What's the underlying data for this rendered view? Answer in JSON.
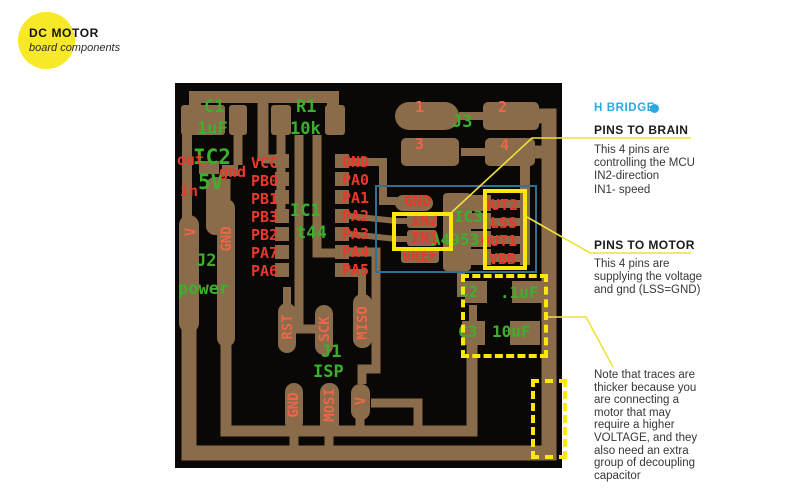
{
  "badge": {
    "title": "DC MOTOR",
    "subtitle": "board components"
  },
  "panel": {
    "h_bridge": "H BRIDGE",
    "brain_heading": "PINS TO BRAIN",
    "brain_lines": [
      "This 4 pins are",
      "controlling the MCU",
      "IN2-direction",
      "IN1- speed"
    ],
    "motor_heading": "PINS TO MOTOR",
    "motor_lines": [
      "This 4 pins are",
      "supplying the voltage",
      "and gnd (LSS=GND)"
    ],
    "note_lines": [
      "Note that traces are",
      "thicker because you",
      "are connecting a",
      "motor that may",
      "require a higher",
      "VOLTAGE, and they",
      "also need an extra",
      "group of decoupling",
      "capacitor"
    ]
  },
  "colors": {
    "badge_yellow": "#f7e928",
    "highlight_yellow": "#fde70a",
    "cyan": "#29abe2",
    "copper": "#8a6b4a",
    "board_black": "#0a0806",
    "silk_green": "#3cb02c",
    "silk_red": "#e8392b",
    "silk_orange": "#ee6648",
    "region_blue": "#2d7196"
  },
  "pcb": {
    "labels": [
      {
        "t": "C1",
        "c": "g",
        "x": 29,
        "y": 16,
        "s": 17
      },
      {
        "t": "1uF",
        "c": "g",
        "x": 22,
        "y": 38,
        "s": 17
      },
      {
        "t": "R1",
        "c": "g",
        "x": 121,
        "y": 16,
        "s": 17
      },
      {
        "t": "10k",
        "c": "g",
        "x": 115,
        "y": 38,
        "s": 17
      },
      {
        "t": "IC2",
        "c": "g",
        "x": 18,
        "y": 64,
        "s": 21
      },
      {
        "t": "5V",
        "c": "g",
        "x": 23,
        "y": 89,
        "s": 21
      },
      {
        "t": "out",
        "c": "r",
        "x": 2,
        "y": 70,
        "s": 15
      },
      {
        "t": "gnd",
        "c": "r",
        "x": 44,
        "y": 82,
        "s": 15
      },
      {
        "t": "in",
        "c": "r",
        "x": 5,
        "y": 101,
        "s": 15
      },
      {
        "t": "IC1",
        "c": "g",
        "x": 115,
        "y": 120,
        "s": 17
      },
      {
        "t": "t44",
        "c": "g",
        "x": 121,
        "y": 142,
        "s": 17
      },
      {
        "t": "J3",
        "c": "g",
        "x": 277,
        "y": 31,
        "s": 17
      },
      {
        "t": "J2",
        "c": "g",
        "x": 21,
        "y": 170,
        "s": 17
      },
      {
        "t": "power",
        "c": "g",
        "x": 3,
        "y": 198,
        "s": 17
      },
      {
        "t": "J1",
        "c": "g",
        "x": 146,
        "y": 261,
        "s": 17
      },
      {
        "t": "ISP",
        "c": "g",
        "x": 138,
        "y": 281,
        "s": 17
      },
      {
        "t": "IC3",
        "c": "g",
        "x": 279,
        "y": 126,
        "s": 16
      },
      {
        "t": "A4953",
        "c": "g",
        "x": 256,
        "y": 149,
        "s": 16
      },
      {
        "t": "C2",
        "c": "g",
        "x": 284,
        "y": 201,
        "s": 16
      },
      {
        "t": ".1uF",
        "c": "g",
        "x": 325,
        "y": 202,
        "s": 16
      },
      {
        "t": "C3",
        "c": "g",
        "x": 283,
        "y": 241,
        "s": 16
      },
      {
        "t": "10uF",
        "c": "g",
        "x": 317,
        "y": 241,
        "s": 16
      },
      {
        "t": "VCC",
        "c": "r",
        "x": 76,
        "y": 73,
        "s": 15
      },
      {
        "t": "PB0",
        "c": "r",
        "x": 76,
        "y": 91,
        "s": 15
      },
      {
        "t": "PB1",
        "c": "r",
        "x": 76,
        "y": 109,
        "s": 15
      },
      {
        "t": "PB3",
        "c": "r",
        "x": 76,
        "y": 127,
        "s": 15
      },
      {
        "t": "PB2",
        "c": "r",
        "x": 76,
        "y": 145,
        "s": 15
      },
      {
        "t": "PA7",
        "c": "r",
        "x": 76,
        "y": 163,
        "s": 15
      },
      {
        "t": "PA6",
        "c": "r",
        "x": 76,
        "y": 181,
        "s": 15
      },
      {
        "t": "GND",
        "c": "r",
        "x": 167,
        "y": 72,
        "s": 15
      },
      {
        "t": "PA0",
        "c": "r",
        "x": 167,
        "y": 90,
        "s": 15
      },
      {
        "t": "PA1",
        "c": "r",
        "x": 167,
        "y": 108,
        "s": 15
      },
      {
        "t": "PA2",
        "c": "r",
        "x": 167,
        "y": 126,
        "s": 15
      },
      {
        "t": "PA3",
        "c": "r",
        "x": 167,
        "y": 144,
        "s": 15
      },
      {
        "t": "PA4",
        "c": "r",
        "x": 167,
        "y": 162,
        "s": 15
      },
      {
        "t": "PA5",
        "c": "r",
        "x": 167,
        "y": 180,
        "s": 15
      },
      {
        "t": "GND",
        "c": "r",
        "x": 229,
        "y": 111,
        "s": 15
      },
      {
        "t": "IN2",
        "c": "r",
        "x": 236,
        "y": 130,
        "s": 15
      },
      {
        "t": "IN1",
        "c": "r",
        "x": 236,
        "y": 148,
        "s": 15
      },
      {
        "t": "VREF",
        "c": "r",
        "x": 227,
        "y": 166,
        "s": 15
      },
      {
        "t": "OUT2",
        "c": "r",
        "x": 307,
        "y": 115,
        "s": 15
      },
      {
        "t": "LSS",
        "c": "r",
        "x": 315,
        "y": 133,
        "s": 15
      },
      {
        "t": "OUT1",
        "c": "r",
        "x": 306,
        "y": 151,
        "s": 15
      },
      {
        "t": "VBB",
        "c": "r",
        "x": 314,
        "y": 169,
        "s": 15
      },
      {
        "t": "1",
        "c": "s",
        "x": 240,
        "y": 17,
        "s": 15
      },
      {
        "t": "2",
        "c": "s",
        "x": 323,
        "y": 17,
        "s": 15
      },
      {
        "t": "3",
        "c": "s",
        "x": 240,
        "y": 54,
        "s": 15
      },
      {
        "t": "4",
        "c": "s",
        "x": 325,
        "y": 55,
        "s": 15
      },
      {
        "t": "V",
        "c": "s",
        "x": 16,
        "y": 149,
        "s": 14,
        "v": true
      },
      {
        "t": "GND",
        "c": "s",
        "x": 52,
        "y": 156,
        "s": 14,
        "v": true
      },
      {
        "t": "RST",
        "c": "s",
        "x": 113,
        "y": 244,
        "s": 14,
        "v": true
      },
      {
        "t": "SCK",
        "c": "s",
        "x": 150,
        "y": 246,
        "s": 14,
        "v": true
      },
      {
        "t": "MISO",
        "c": "s",
        "x": 188,
        "y": 240,
        "s": 14,
        "v": true
      },
      {
        "t": "GND",
        "c": "s",
        "x": 119,
        "y": 322,
        "s": 14,
        "v": true
      },
      {
        "t": "MOSI",
        "c": "s",
        "x": 155,
        "y": 322,
        "s": 14,
        "v": true
      },
      {
        "t": "V",
        "c": "s",
        "x": 186,
        "y": 318,
        "s": 14,
        "v": true
      }
    ]
  }
}
